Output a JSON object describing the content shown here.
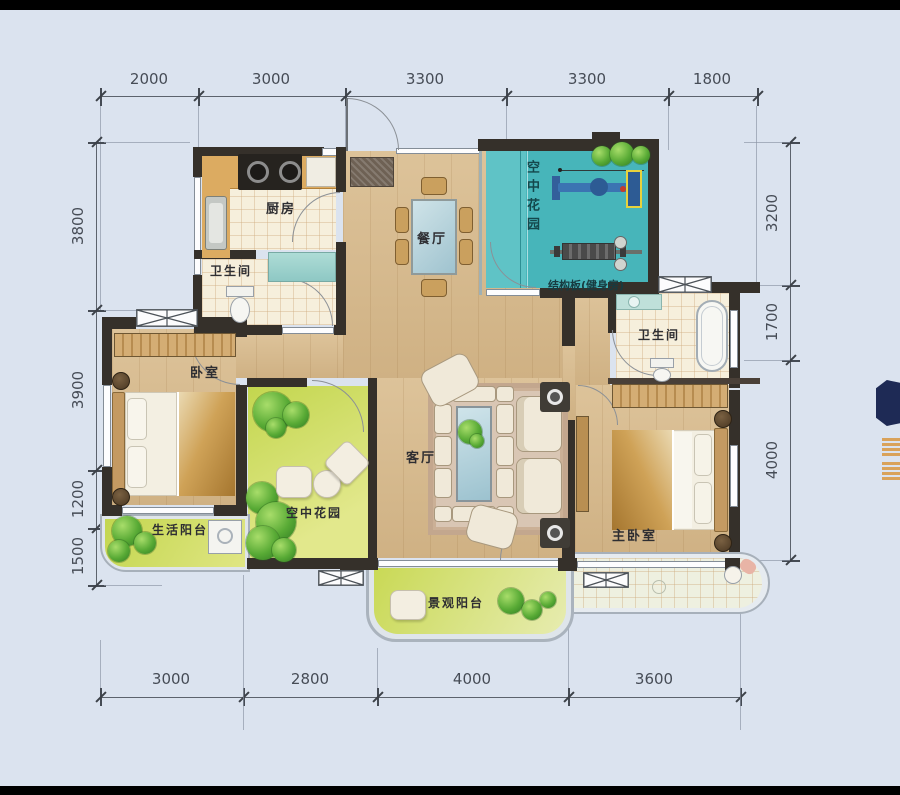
{
  "plan": {
    "title": "apartment-floor-plan",
    "rooms": {
      "kitchen": "厨房",
      "bathroom1": "卫生间",
      "dining": "餐厅",
      "sky_garden_top": "空中花园",
      "gym_note": "结构板(健身房)",
      "bedroom": "卧室",
      "sky_garden_mid": "空中花园",
      "living": "客厅",
      "bathroom2": "卫生间",
      "master_bedroom": "主卧室",
      "life_balcony": "生活阳台",
      "view_balcony": "景观阳台"
    },
    "dimensions": {
      "top": [
        "2000",
        "3000",
        "3300",
        "3300",
        "1800"
      ],
      "bottom": [
        "3000",
        "2800",
        "4000",
        "3600"
      ],
      "left": [
        "3800",
        "3900",
        "1200",
        "1500"
      ],
      "right": [
        "3200",
        "1700",
        "4000"
      ]
    },
    "colors": {
      "background": "#dbe3ef",
      "wall": "#35302a",
      "wood_floor": "#d9bc8e",
      "tile_floor": "#f6efdc",
      "sky_garden_teal": "#47b5ba",
      "garden_green": "#c8d84f",
      "dimension_text": "#464c56",
      "watermark_navy": "#1e2a55",
      "watermark_orange": "#d9973f"
    }
  }
}
